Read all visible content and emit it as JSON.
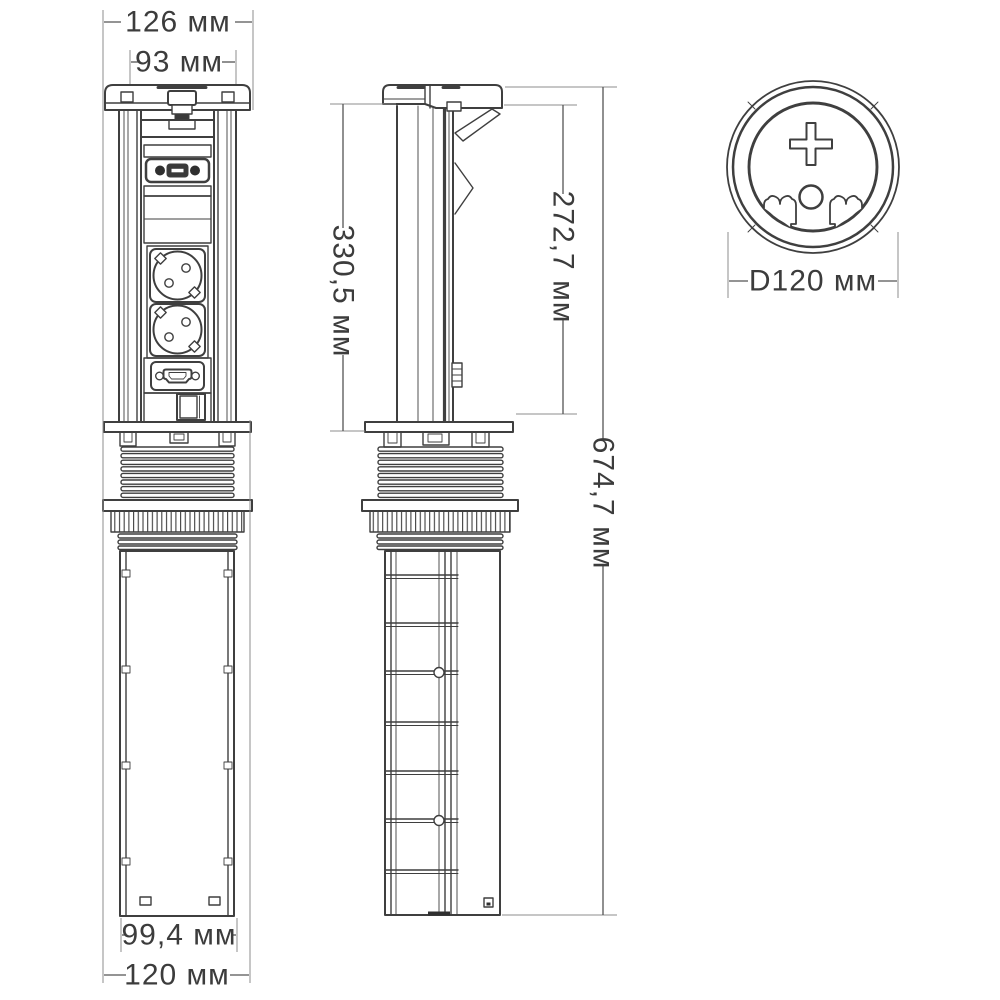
{
  "drawing": {
    "type": "technical-drawing",
    "colors": {
      "line": "#3f3f3f",
      "dim_line": "#8c8c8c",
      "text": "#3c3c3c",
      "background": "#ffffff"
    },
    "front_view": {
      "dims": {
        "cap_width": "126 мм",
        "body_width": "93 мм",
        "tube_width": "99,4 мм",
        "base_width": "120 мм"
      }
    },
    "side_view": {
      "dims": {
        "upper_section_height": "330,5 мм",
        "column_height": "272,7 мм",
        "total_height": "674,7 мм"
      }
    },
    "top_view": {
      "dims": {
        "diameter": "D120 мм"
      }
    }
  }
}
